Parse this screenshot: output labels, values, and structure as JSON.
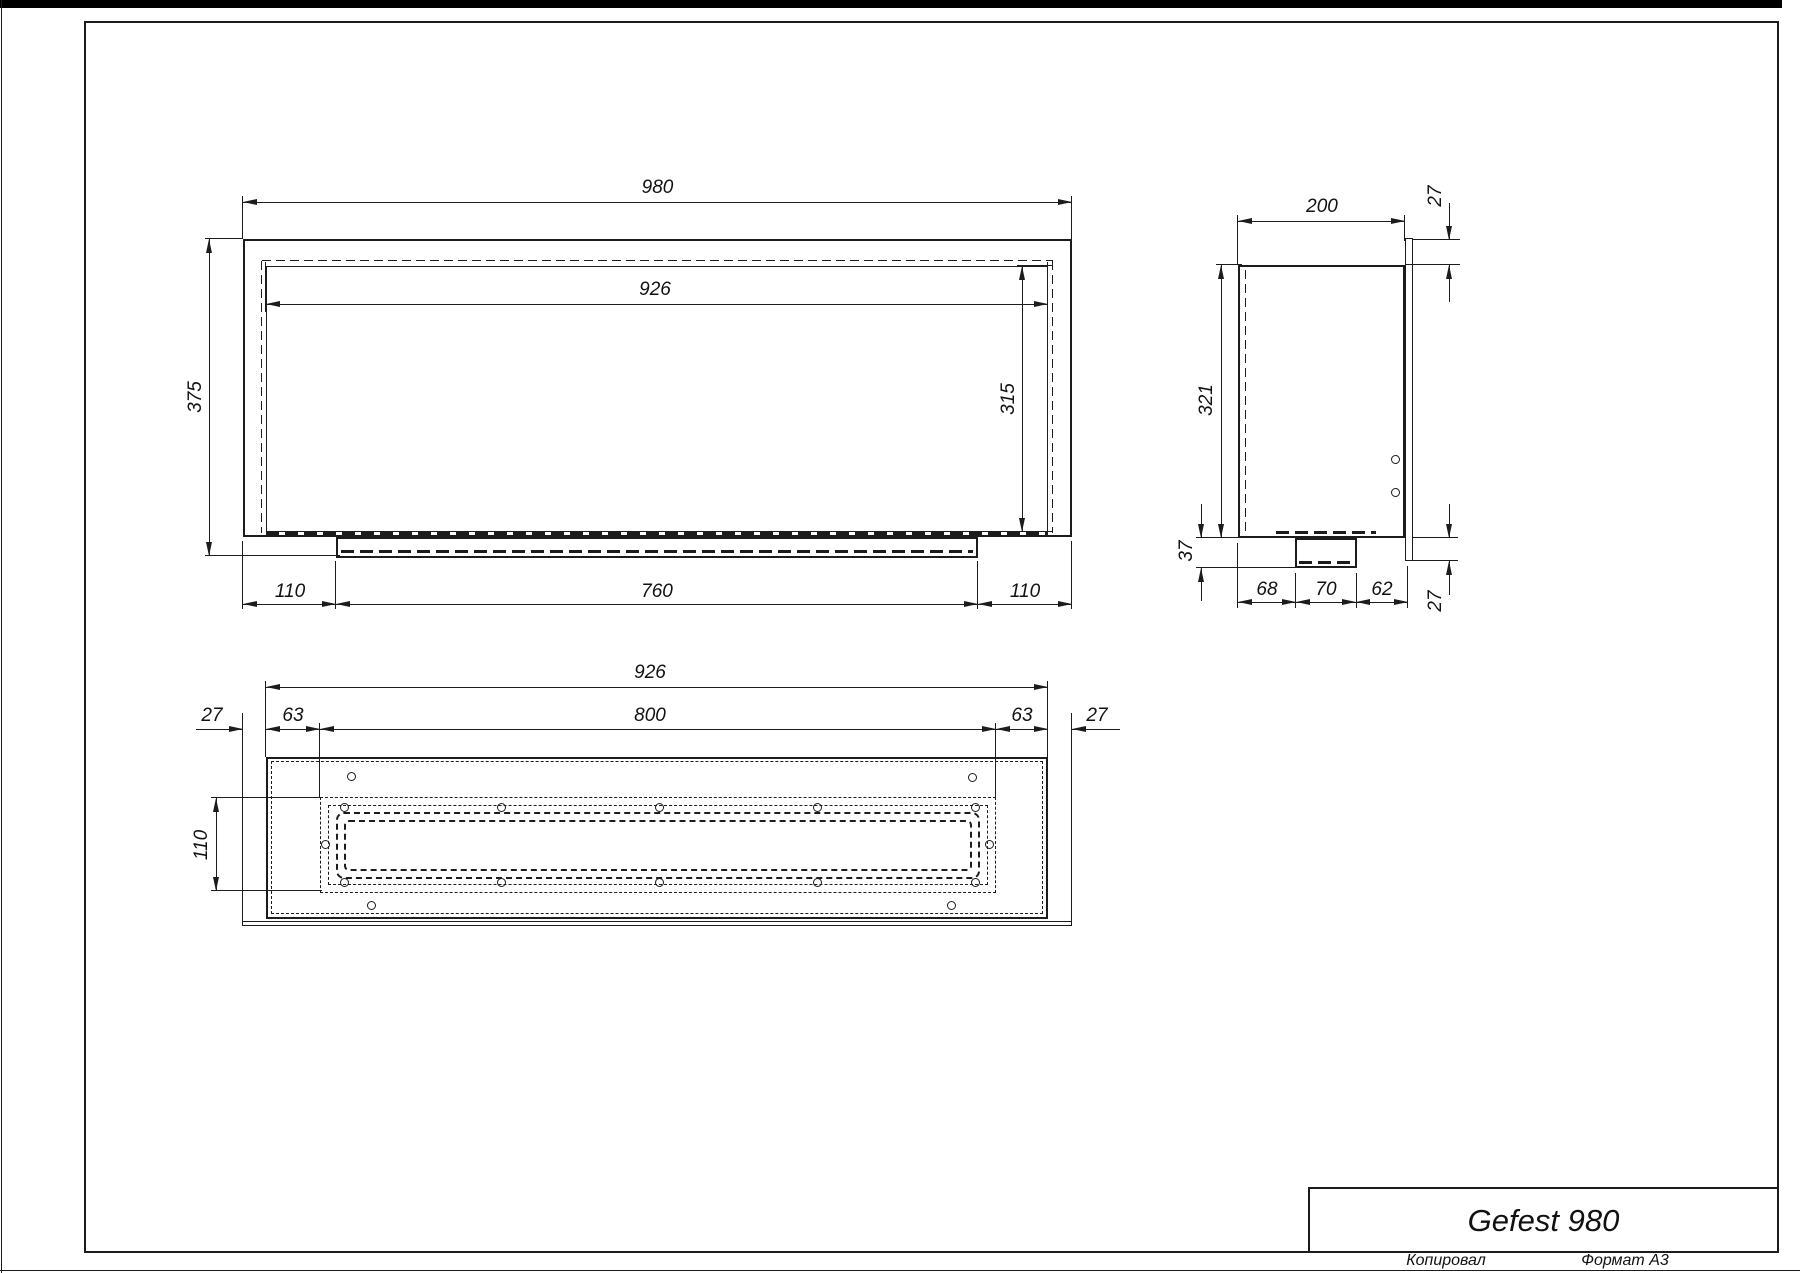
{
  "drawing": {
    "front_view": {
      "overall_width": "980",
      "inner_width": "926",
      "overall_height": "375",
      "inner_height": "315",
      "bottom_left": "110",
      "bottom_center": "760",
      "bottom_right": "110"
    },
    "side_view": {
      "depth": "200",
      "flange_top": "27",
      "height": "321",
      "burner_depth": "37",
      "bottom_left": "68",
      "bottom_center": "70",
      "bottom_right": "62",
      "flange_bottom": "27"
    },
    "bottom_view": {
      "inner_width": "926",
      "flange_left": "27",
      "margin_left": "63",
      "opening_width": "800",
      "margin_right": "63",
      "flange_right": "27",
      "opening_depth": "110"
    },
    "title_block": {
      "product": "Gefest 980",
      "copied_label": "Копировал",
      "format_label": "Формат А3"
    }
  }
}
